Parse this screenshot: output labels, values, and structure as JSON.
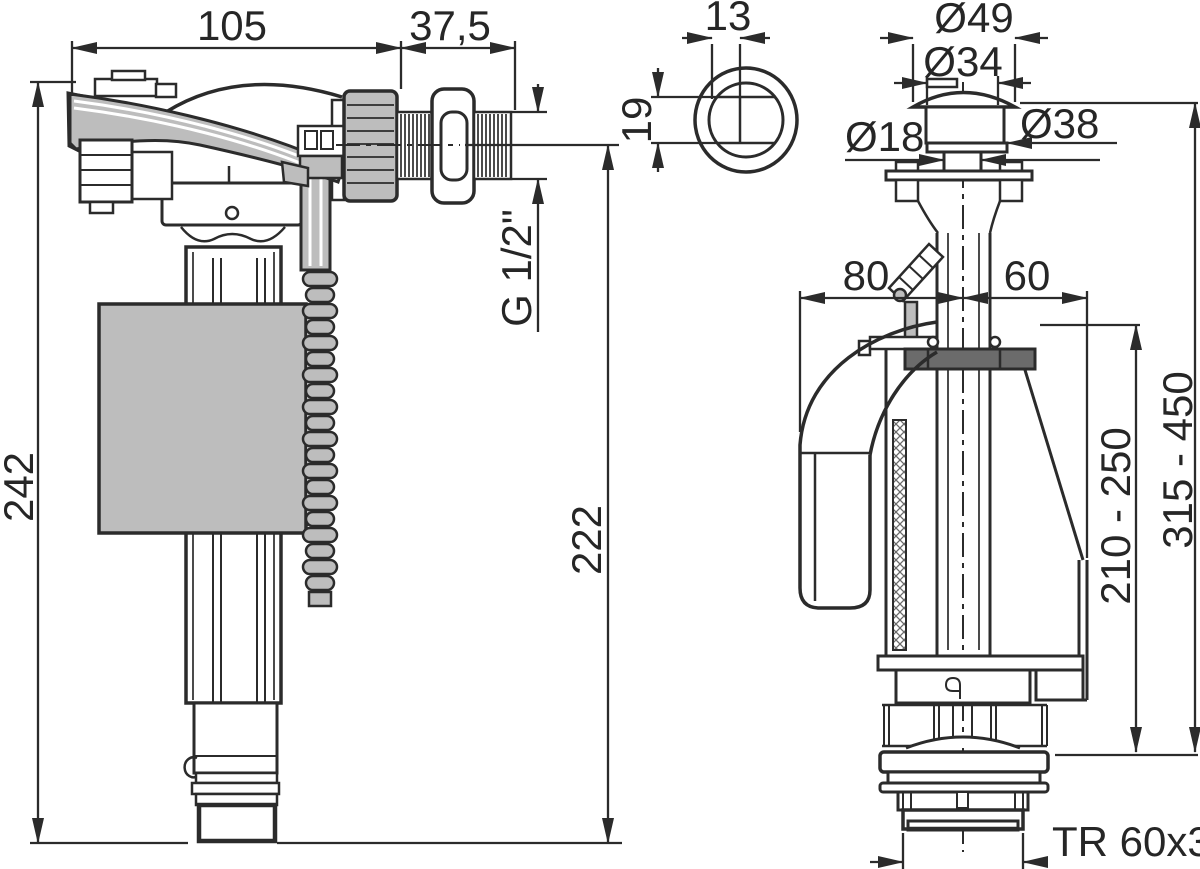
{
  "colors": {
    "line": "#2b2b2b",
    "light_gray": "#bdbdbd",
    "dark_gray": "#6b6b6b",
    "background": "#ffffff"
  },
  "fill_valve": {
    "dim_width_top": "105",
    "dim_thread_length": "37,5",
    "dim_total_height": "242",
    "dim_thread_size": "G 1/2\"",
    "dim_axis_height": "222"
  },
  "push_button": {
    "dim_slot_width": "13",
    "dim_slot_height": "19"
  },
  "flush_valve": {
    "dim_button_cap": "Ø49",
    "dim_button_body": "Ø34",
    "dim_button_neck": "Ø18",
    "dim_button_base": "Ø38",
    "dim_offset_left": "80",
    "dim_offset_right": "60",
    "dim_height_range_inner": "210 - 250",
    "dim_height_range_outer": "315 - 450",
    "dim_outlet_thread": "TR 60x3"
  }
}
